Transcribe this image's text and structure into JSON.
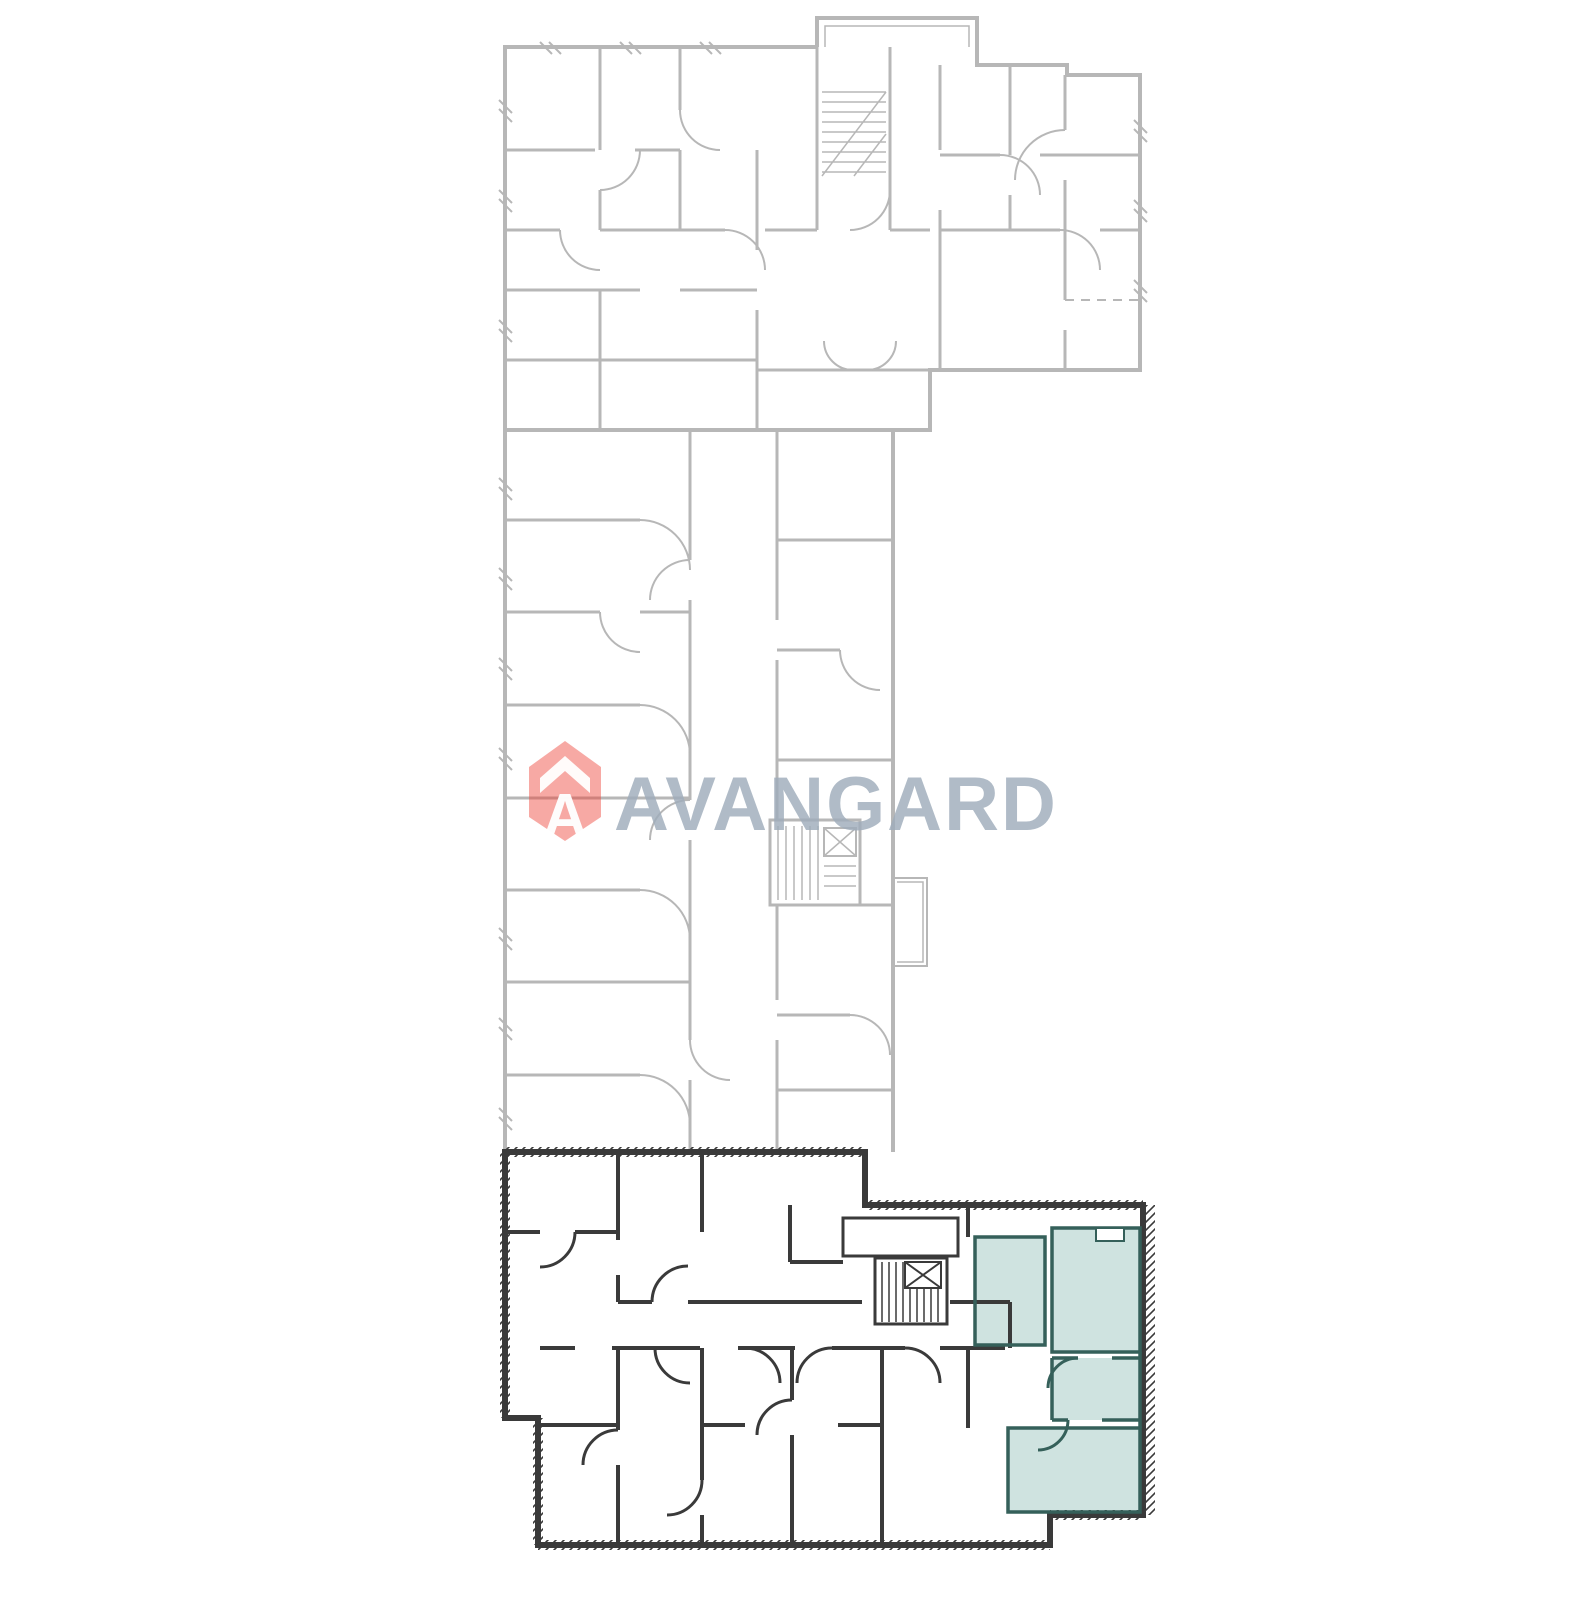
{
  "page": {
    "background_color": "#ffffff",
    "description": "building floor plan with highlighted apartment"
  },
  "watermark": {
    "brand_text": "AVANGARD",
    "brand_letter": "A",
    "icon": "avangard-house-shield-icon",
    "icon_color": "#ee4036",
    "icon_chevron_color": "#ffffff",
    "text_color": "#9fadbb"
  },
  "floorplan": {
    "light_line_color": "#b7b7b7",
    "dark_line_color": "#3a3a3a",
    "wall_hatch_color": "#3a3a3a",
    "highlight_fill": "#cfe3e0",
    "highlight_wall_color": "#35605a",
    "highlighted_unit": "selected-apartment-bottom-right",
    "upper_section_state": "inactive",
    "lower_section_state": "active"
  }
}
